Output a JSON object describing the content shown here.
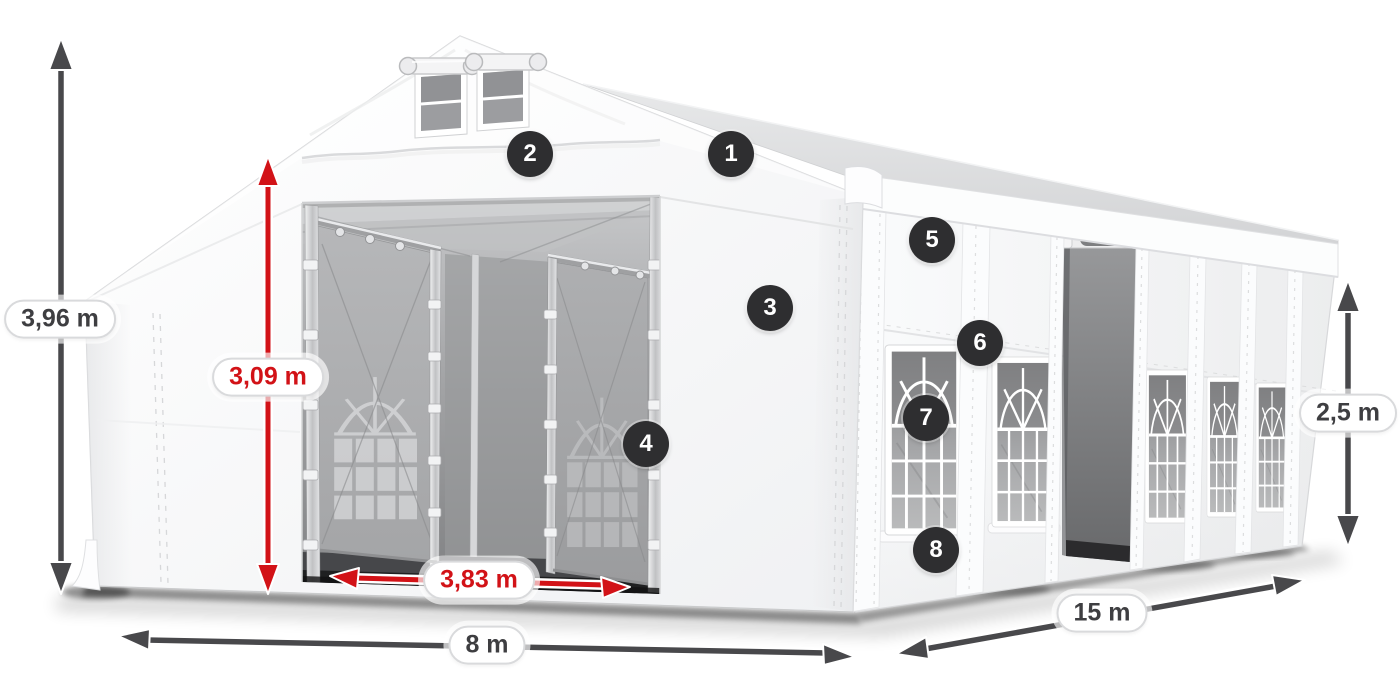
{
  "dimensions": {
    "total_height": "3,96 m",
    "inner_height": "3,09 m",
    "door_width": "3,83 m",
    "width": "8 m",
    "length": "15 m",
    "side_height": "2,5 m"
  },
  "callouts": [
    "1",
    "2",
    "3",
    "4",
    "5",
    "6",
    "7",
    "8"
  ],
  "colors": {
    "accent_red": "#d21217",
    "dimension_arrow_gray": "#48484b",
    "badge_background": "#2e2e30",
    "badge_text": "#ffffff",
    "pill_background": "#ffffff",
    "pill_border": "#d9dadc",
    "pill_text_dark": "#3e3e41",
    "tent_fabric": "#f6f7f8",
    "interior_shade": "#a4a5a7"
  },
  "icons": {
    "dimension_arrow": "double-headed-arrow",
    "callout_badge": "numbered-circle"
  }
}
